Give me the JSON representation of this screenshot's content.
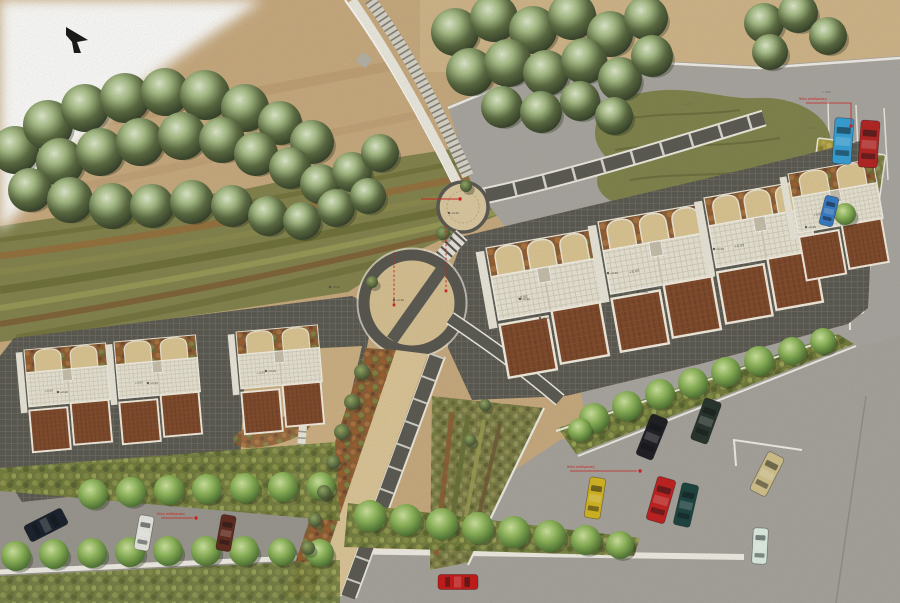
{
  "scene": {
    "type": "architectural-site-plan-rendering",
    "width": 900,
    "height": 603,
    "view": "top-down masterplan"
  },
  "palette": {
    "sand": "#c8a97d",
    "sand_light": "#d3b88b",
    "plaza_sand": "#d7c192",
    "asphalt_upper": "#a8a5a1",
    "asphalt_lower": "#a5a29d",
    "asphalt_left": "#98958f",
    "tile_dark": "#56554e",
    "terrace": "#eae6d8",
    "roof_brown": "#7c4426",
    "white_path": "#f1efe7",
    "annotation_red": "#cf1d1d",
    "forest_green": "#55663c",
    "street_green": "#86b054",
    "mound_olive": "#7d8148"
  },
  "north_arrow": {
    "points": "66,27 88,40 77,42 81,53 74,53 72,42 66,35"
  },
  "annotations": {
    "leaders": [
      {
        "text": "θέση στάθμευσης",
        "tx": 799,
        "ty": 100,
        "path": "M806,103 L851,103 L851,124",
        "dot": [
          851,
          126
        ]
      },
      {
        "text": "θέση στάθμευσης",
        "tx": 567,
        "ty": 468,
        "path": "M570,471 L637,471",
        "dot": [
          640,
          471
        ]
      },
      {
        "text": "θέση στάθμευσης",
        "tx": 157,
        "ty": 515,
        "path": "M161,518 L193,518",
        "dot": [
          196,
          518
        ]
      }
    ],
    "section_lines": [
      {
        "x1": 394,
        "y1": 252,
        "x2": 394,
        "y2": 305
      },
      {
        "x1": 446,
        "y1": 226,
        "x2": 446,
        "y2": 291
      }
    ],
    "leader_h": {
      "x1": 421,
      "y1": 199,
      "x2": 458,
      "y2": 199,
      "dot": [
        460,
        199
      ]
    },
    "level_markers": [
      [
        449,
        213
      ],
      [
        394,
        300
      ],
      [
        520,
        299
      ],
      [
        608,
        273
      ],
      [
        714,
        249
      ],
      [
        806,
        227
      ],
      [
        58,
        392
      ],
      [
        148,
        383
      ],
      [
        266,
        371
      ],
      [
        330,
        287
      ],
      [
        540,
        318
      ],
      [
        638,
        292
      ]
    ],
    "level_text": "+0.00",
    "small_marks": [
      {
        "x": 822,
        "y": 93,
        "t": "+ 0.00"
      },
      {
        "x": 806,
        "y": 129,
        "t": "+0.00"
      },
      {
        "x": 683,
        "y": 105,
        "t": "+ 0.00"
      }
    ]
  },
  "cars": [
    {
      "c": "#2f9fd8",
      "x": 843,
      "y": 141,
      "w": 19,
      "h": 46,
      "rot": 4,
      "n": "blue-car-parked"
    },
    {
      "c": "#b31e1e",
      "x": 869,
      "y": 144,
      "w": 19,
      "h": 47,
      "rot": 4,
      "n": "red-car-parked"
    },
    {
      "c": "#2f78c8",
      "x": 829,
      "y": 211,
      "w": 14,
      "h": 30,
      "rot": 14,
      "n": "blue-car-courtyard"
    },
    {
      "c": "#17171f",
      "x": 652,
      "y": 437,
      "w": 18,
      "h": 44,
      "rot": 22,
      "n": "black-car"
    },
    {
      "c": "#202e28",
      "x": 706,
      "y": 421,
      "w": 18,
      "h": 44,
      "rot": 20,
      "n": "dark-green-car"
    },
    {
      "c": "#c01a1a",
      "x": 661,
      "y": 500,
      "w": 19,
      "h": 45,
      "rot": 16,
      "n": "red-car"
    },
    {
      "c": "#153e3c",
      "x": 686,
      "y": 505,
      "w": 17,
      "h": 43,
      "rot": 13,
      "n": "teal-car"
    },
    {
      "c": "#d4b51c",
      "x": 595,
      "y": 498,
      "w": 16,
      "h": 41,
      "rot": 9,
      "n": "yellow-car"
    },
    {
      "c": "#d2c28a",
      "x": 767,
      "y": 474,
      "w": 18,
      "h": 43,
      "rot": 27,
      "n": "tan-car"
    },
    {
      "c": "#dff0e6",
      "x": 760,
      "y": 546,
      "w": 15,
      "h": 36,
      "rot": 3,
      "n": "white-car"
    },
    {
      "c": "#111a28",
      "x": 46,
      "y": 525,
      "w": 18,
      "h": 42,
      "rot": 63,
      "n": "navy-car"
    },
    {
      "c": "#e9e9e5",
      "x": 144,
      "y": 533,
      "w": 15,
      "h": 35,
      "rot": 10,
      "n": "white-car"
    },
    {
      "c": "#5c241a",
      "x": 226,
      "y": 533,
      "w": 15,
      "h": 36,
      "rot": 10,
      "n": "maroon-car"
    },
    {
      "c": "#c51313",
      "x": 458,
      "y": 582,
      "w": 15,
      "h": 40,
      "rot": 90,
      "n": "red-car-driving"
    }
  ],
  "trees": {
    "forest": [
      [
        15,
        150,
        24
      ],
      [
        48,
        125,
        25
      ],
      [
        85,
        108,
        24
      ],
      [
        125,
        98,
        25
      ],
      [
        165,
        92,
        24
      ],
      [
        205,
        95,
        25
      ],
      [
        245,
        108,
        24
      ],
      [
        280,
        123,
        22
      ],
      [
        312,
        142,
        22
      ],
      [
        60,
        162,
        24
      ],
      [
        100,
        152,
        24
      ],
      [
        140,
        142,
        24
      ],
      [
        182,
        136,
        24
      ],
      [
        222,
        140,
        23
      ],
      [
        256,
        154,
        22
      ],
      [
        290,
        168,
        21
      ],
      [
        320,
        184,
        20
      ],
      [
        30,
        190,
        22
      ],
      [
        70,
        200,
        23
      ],
      [
        112,
        206,
        23
      ],
      [
        152,
        206,
        22
      ],
      [
        192,
        202,
        22
      ],
      [
        232,
        206,
        21
      ],
      [
        268,
        216,
        20
      ],
      [
        302,
        221,
        19
      ],
      [
        336,
        208,
        19
      ],
      [
        352,
        172,
        20
      ],
      [
        380,
        153,
        19
      ],
      [
        368,
        196,
        18
      ],
      [
        455,
        32,
        24
      ],
      [
        494,
        18,
        24
      ],
      [
        533,
        30,
        24
      ],
      [
        572,
        16,
        24
      ],
      [
        610,
        34,
        23
      ],
      [
        646,
        18,
        22
      ],
      [
        470,
        72,
        24
      ],
      [
        508,
        63,
        24
      ],
      [
        546,
        73,
        23
      ],
      [
        584,
        61,
        23
      ],
      [
        620,
        79,
        22
      ],
      [
        652,
        56,
        21
      ],
      [
        502,
        107,
        21
      ],
      [
        541,
        112,
        21
      ],
      [
        580,
        101,
        20
      ],
      [
        614,
        116,
        19
      ],
      [
        764,
        23,
        20
      ],
      [
        798,
        13,
        20
      ],
      [
        828,
        36,
        19
      ],
      [
        770,
        52,
        18
      ]
    ],
    "street": [
      [
        93,
        494,
        15
      ],
      [
        131,
        492,
        15
      ],
      [
        169,
        490,
        15
      ],
      [
        207,
        489,
        15
      ],
      [
        245,
        488,
        15
      ],
      [
        283,
        487,
        15
      ],
      [
        321,
        486,
        14
      ],
      [
        16,
        556,
        15
      ],
      [
        54,
        554,
        15
      ],
      [
        92,
        553,
        15
      ],
      [
        130,
        552,
        15
      ],
      [
        168,
        551,
        15
      ],
      [
        206,
        551,
        15
      ],
      [
        244,
        551,
        15
      ],
      [
        282,
        552,
        14
      ],
      [
        320,
        553,
        14
      ],
      [
        370,
        516,
        16
      ],
      [
        406,
        520,
        16
      ],
      [
        442,
        524,
        16
      ],
      [
        478,
        528,
        16
      ],
      [
        514,
        532,
        16
      ],
      [
        550,
        536,
        16
      ],
      [
        586,
        540,
        15
      ],
      [
        620,
        545,
        14
      ],
      [
        594,
        418,
        15
      ],
      [
        627,
        406,
        15
      ],
      [
        660,
        394,
        15
      ],
      [
        693,
        383,
        15
      ],
      [
        726,
        372,
        15
      ],
      [
        759,
        361,
        15
      ],
      [
        792,
        351,
        14
      ],
      [
        823,
        341,
        13
      ],
      [
        845,
        214,
        11
      ],
      [
        580,
        430,
        12
      ]
    ],
    "bush": [
      [
        362,
        372,
        8
      ],
      [
        352,
        402,
        8
      ],
      [
        342,
        432,
        8
      ],
      [
        333,
        462,
        7
      ],
      [
        324,
        492,
        7
      ],
      [
        315,
        520,
        7
      ],
      [
        308,
        548,
        7
      ],
      [
        443,
        233,
        7
      ],
      [
        466,
        186,
        6
      ],
      [
        372,
        282,
        6
      ],
      [
        485,
        405,
        6
      ],
      [
        470,
        440,
        6
      ]
    ]
  },
  "buildings": {
    "left_units": [
      {
        "x": 24,
        "y": 350,
        "rot": -5,
        "s": 0.95,
        "arches": 2
      },
      {
        "x": 114,
        "y": 342,
        "rot": -5,
        "s": 0.95,
        "arches": 2
      },
      {
        "x": 236,
        "y": 332,
        "rot": -5,
        "s": 0.95,
        "arches": 2
      }
    ],
    "right_units": [
      {
        "x": 486,
        "y": 248,
        "rot": -10,
        "s": 1.22,
        "arches": 3
      },
      {
        "x": 598,
        "y": 222,
        "rot": -10,
        "s": 1.22,
        "arches": 3
      },
      {
        "x": 704,
        "y": 198,
        "rot": -10,
        "s": 1.18,
        "arches": 3
      },
      {
        "x": 788,
        "y": 174,
        "rot": -10,
        "s": 1.0,
        "arches": 2
      }
    ]
  },
  "planting_beds": [
    {
      "x": 818,
      "y": 138,
      "w": 46,
      "h": 27,
      "rot": 7,
      "fill": "plantYellow"
    },
    {
      "x": 850,
      "y": 150,
      "w": 36,
      "h": 160,
      "rot": 8,
      "fill": "plantOlive"
    },
    {
      "x": 760,
      "y": 180,
      "w": 60,
      "h": 25,
      "rot": 7,
      "fill": "plantOlive"
    },
    {
      "x": 696,
      "y": 204,
      "w": 58,
      "h": 24,
      "rot": 6,
      "fill": "plantYellow"
    }
  ]
}
